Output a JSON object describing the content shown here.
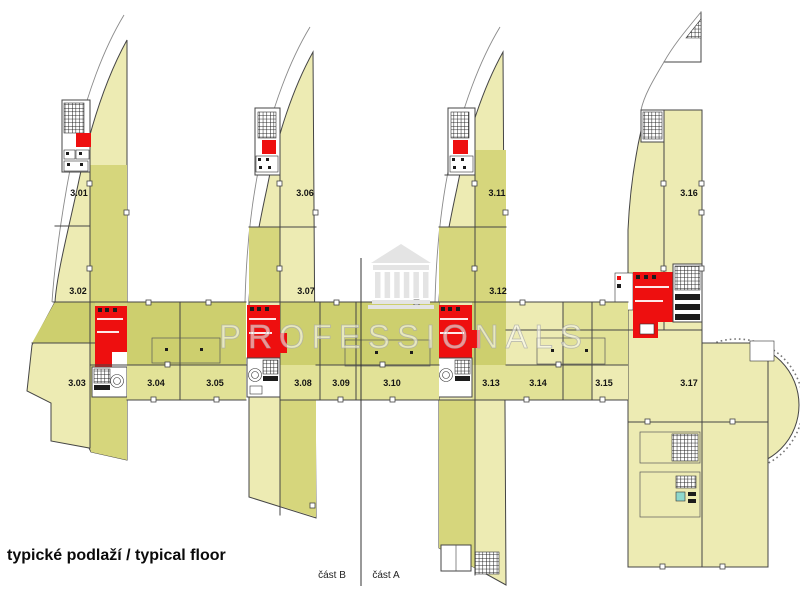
{
  "title": "typické podlaží / typical floor",
  "watermark": {
    "text": "PROFESSIONALS",
    "icon": "temple-icon"
  },
  "sections": {
    "left": "část B",
    "right": "část A"
  },
  "rooms": [
    {
      "label": "3.01"
    },
    {
      "label": "3.02"
    },
    {
      "label": "3.03"
    },
    {
      "label": "3.04"
    },
    {
      "label": "3.05"
    },
    {
      "label": "3.06"
    },
    {
      "label": "3.07"
    },
    {
      "label": "3.08"
    },
    {
      "label": "3.09"
    },
    {
      "label": "3.10"
    },
    {
      "label": "3.11"
    },
    {
      "label": "3.12"
    },
    {
      "label": "3.13"
    },
    {
      "label": "3.14"
    },
    {
      "label": "3.15"
    },
    {
      "label": "3.16"
    },
    {
      "label": "3.17"
    }
  ],
  "colors": {
    "wing_pale": "#EDEBB3",
    "wing_olive": "#D6D67C",
    "band_dark": "#CDCF6E",
    "band_light": "#E2E297",
    "core_red": "#EE0F0F",
    "wall": "#454545",
    "watermark_gray": "#E4E4E4",
    "fixture_teal": "#8FD8CC",
    "background": "#FFFFFF"
  }
}
